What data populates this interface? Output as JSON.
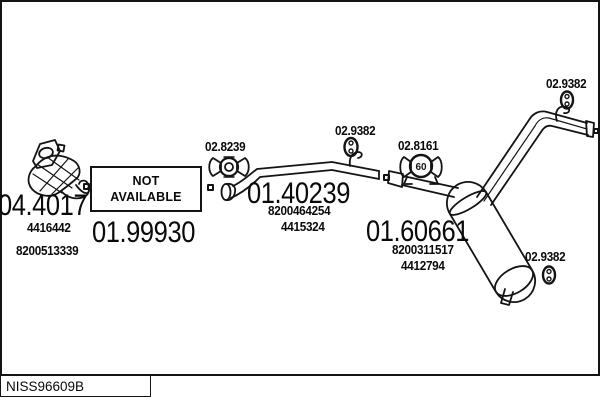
{
  "footer": {
    "drawing_code": "NISS96609B"
  },
  "colors": {
    "line": "#141414",
    "background": "#ffffff"
  },
  "parts": {
    "catalyst": {
      "code": "04.4017",
      "refs": [
        "4416442",
        "8200513339"
      ]
    },
    "front_pipe": {
      "code": "01.99930",
      "availability": [
        "NOT",
        "AVAILABLE"
      ]
    },
    "center_pipe": {
      "code": "01.40239",
      "refs": [
        "8200464254",
        "4415324"
      ]
    },
    "rear_silencer": {
      "code": "01.60661",
      "refs": [
        "8200311517",
        "4412794"
      ]
    },
    "clamp_front": {
      "code": "02.8239"
    },
    "clamp_rear": {
      "code": "02.8161",
      "diameter": "60"
    },
    "hanger_center": {
      "code": "02.9382"
    },
    "hanger_top_right": {
      "code": "02.9382"
    },
    "hanger_bottom_right": {
      "code": "02.9382"
    }
  }
}
